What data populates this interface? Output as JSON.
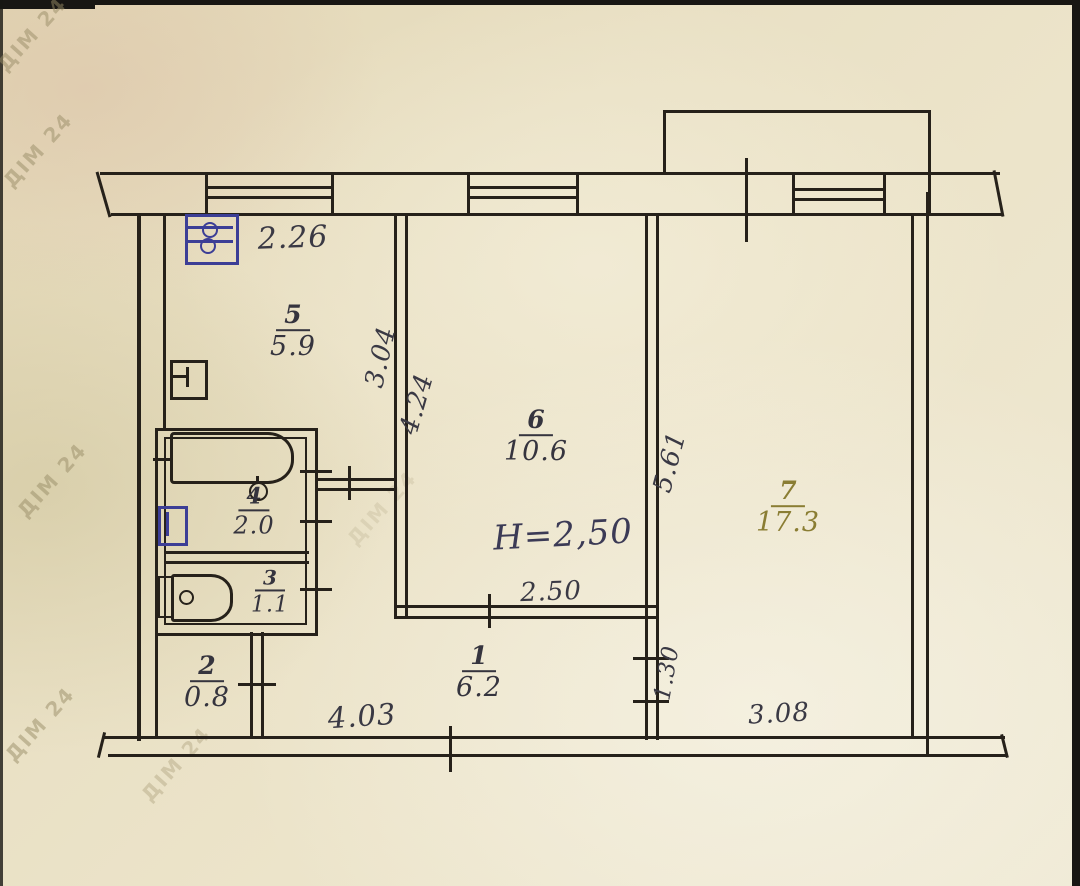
{
  "plan": {
    "height_note": "H=2,50",
    "watermark": "ДІМ 24",
    "rooms": [
      {
        "number": "5",
        "area": "5.9"
      },
      {
        "number": "6",
        "area": "10.6"
      },
      {
        "number": "7",
        "area": "17.3"
      },
      {
        "number": "4",
        "area": "2.0"
      },
      {
        "number": "3",
        "area": "1.1"
      },
      {
        "number": "2",
        "area": "0.8"
      },
      {
        "number": "1",
        "area": "6.2"
      }
    ],
    "dimensions": {
      "kitchen_width": "2.26",
      "kitchen_depth": "3.04",
      "room6_depth": "4.24",
      "room6_width": "2.50",
      "room7_depth": "5.61",
      "hall_right_wall": "1.30",
      "bottom_left": "4.03",
      "bottom_right": "3.08"
    },
    "colors": {
      "paper": "#e9e0c4",
      "ink": "#26211a",
      "handwriting": "#3a3944",
      "blue_fixture": "#3c3e96",
      "room7_ink": "#8a7d33"
    }
  }
}
